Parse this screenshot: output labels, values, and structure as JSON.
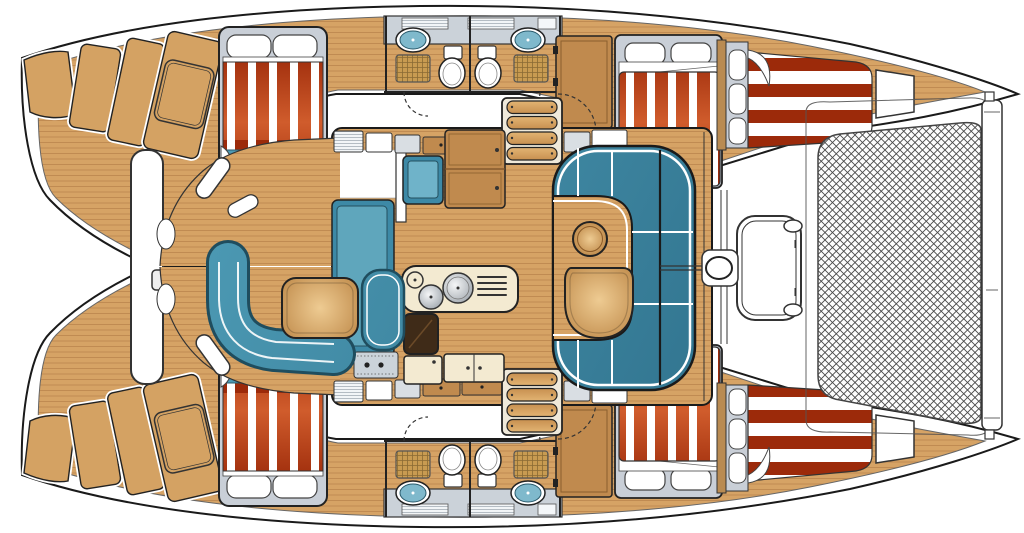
{
  "diagram": {
    "kind": "boat-floor-plan",
    "subject": "catamaran-interior-layout-top-view",
    "orientation": "bow-right-stern-left"
  },
  "colors": {
    "outline": "#1a1a1a",
    "wood": "#D6A365",
    "wood_grain": "#B8834C",
    "wood_cabinet": "#C08A4E",
    "table_light": "#EECB92",
    "table_dark": "#B8803F",
    "upholstery_blue": "#4E9CB6",
    "upholstery_blue_dark": "#31748F",
    "sink_blue": "#7FB9CC",
    "stripe_red": "#9C2A0A",
    "stripe_red_light": "#D05C2C",
    "surround_gray": "#C9CFD7",
    "counter_cream": "#F3EAD1",
    "cooktop_brown": "#3F2B18",
    "mesh_line": "#4a4a4a",
    "wicker": "#C89B51",
    "wicker_line": "#8a6a33",
    "white": "#ffffff"
  },
  "areas": {
    "stern_steps": "transom steps",
    "aft_cabin": "aft cabin double berth",
    "head": "bathroom with toilet, sink and shower grate",
    "forward_cabin": "forward double berth",
    "bow_berth": "bow berth",
    "saloon": "saloon",
    "dinette": "C-shaped dinette with table and stool",
    "galley": "galley with twin sinks, drainer and cooktop",
    "nav_station": "chart desk with instrument panel",
    "cockpit": "aft cockpit with settee and table",
    "foredeck": "foredeck with locker hatch and windlass",
    "trampoline": "bow trampoline net",
    "crossbeam": "forward crossbeam"
  },
  "counts": {
    "hulls": 2,
    "cabins": 6,
    "heads": 4,
    "sinks_galley": 2,
    "toilets": 4
  }
}
